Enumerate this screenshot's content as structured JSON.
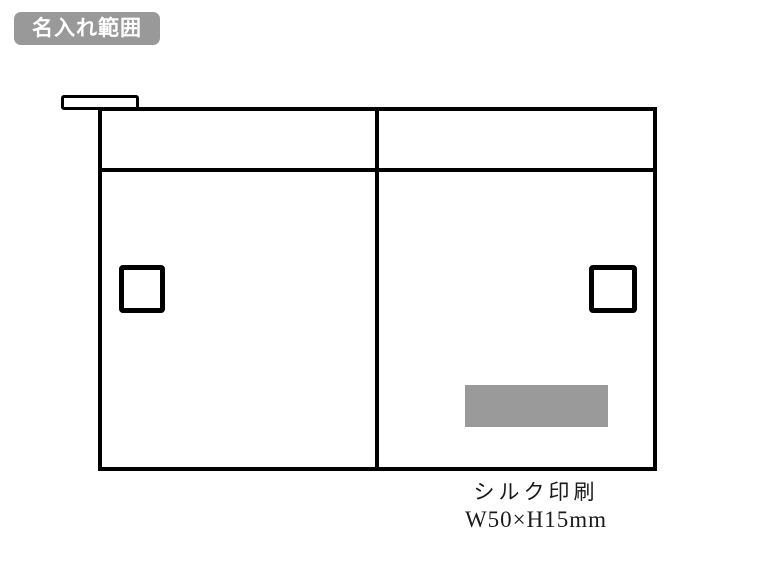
{
  "page": {
    "background_color": "#ffffff"
  },
  "badge": {
    "label": "名入れ範囲",
    "background_color": "#999999",
    "text_color": "#ffffff"
  },
  "diagram": {
    "outline_color": "#000000",
    "print_area": {
      "fill_color": "#9a9a9a"
    },
    "caption": {
      "method": "シルク印刷",
      "size": "W50×H15mm"
    }
  }
}
